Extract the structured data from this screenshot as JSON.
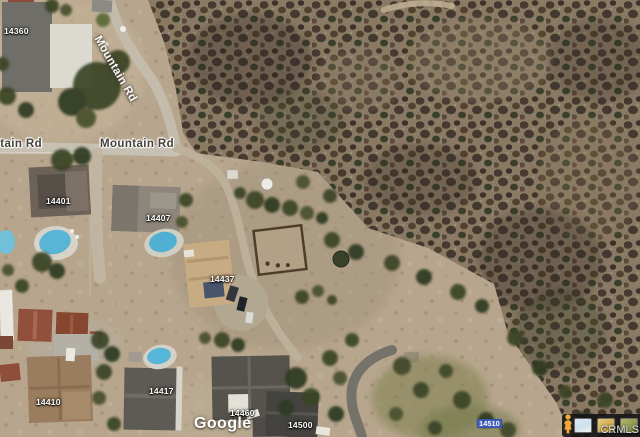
{
  "map_labels": {
    "roads": [
      {
        "id": "mountain-rd-diagonal",
        "text": "Mountain Rd"
      },
      {
        "id": "mountain-rd-west-clipped",
        "text": "Mountain Rd"
      },
      {
        "id": "mountain-rd-center",
        "text": "Mountain Rd"
      }
    ],
    "addresses": [
      {
        "text": "14360"
      },
      {
        "text": "14401"
      },
      {
        "text": "14407"
      },
      {
        "text": "14437"
      },
      {
        "text": "14410"
      },
      {
        "text": "14417"
      },
      {
        "text": "14460"
      },
      {
        "text": "14500"
      }
    ],
    "highlighted_address": {
      "text": "14510"
    }
  },
  "attribution": {
    "logo": "Google",
    "provider": "CRMLS"
  },
  "controls": {
    "pegman": "street-view-pegman",
    "thumbnails": [
      {
        "name": "map-style-thumbnail-1"
      },
      {
        "name": "map-style-thumbnail-2"
      },
      {
        "name": "map-style-thumbnail-3"
      }
    ]
  },
  "colors": {
    "dirt": "#b7a68d",
    "brush_base": "#8a7963",
    "brush_dark": "#463a30",
    "road": "#c6c0b2",
    "pool": "#58b5d5",
    "roof_dark_gray": "#56534d",
    "roof_red": "#91503c",
    "highlight_blue": "#3d58b4",
    "pegman_yellow": "#f2a737"
  }
}
